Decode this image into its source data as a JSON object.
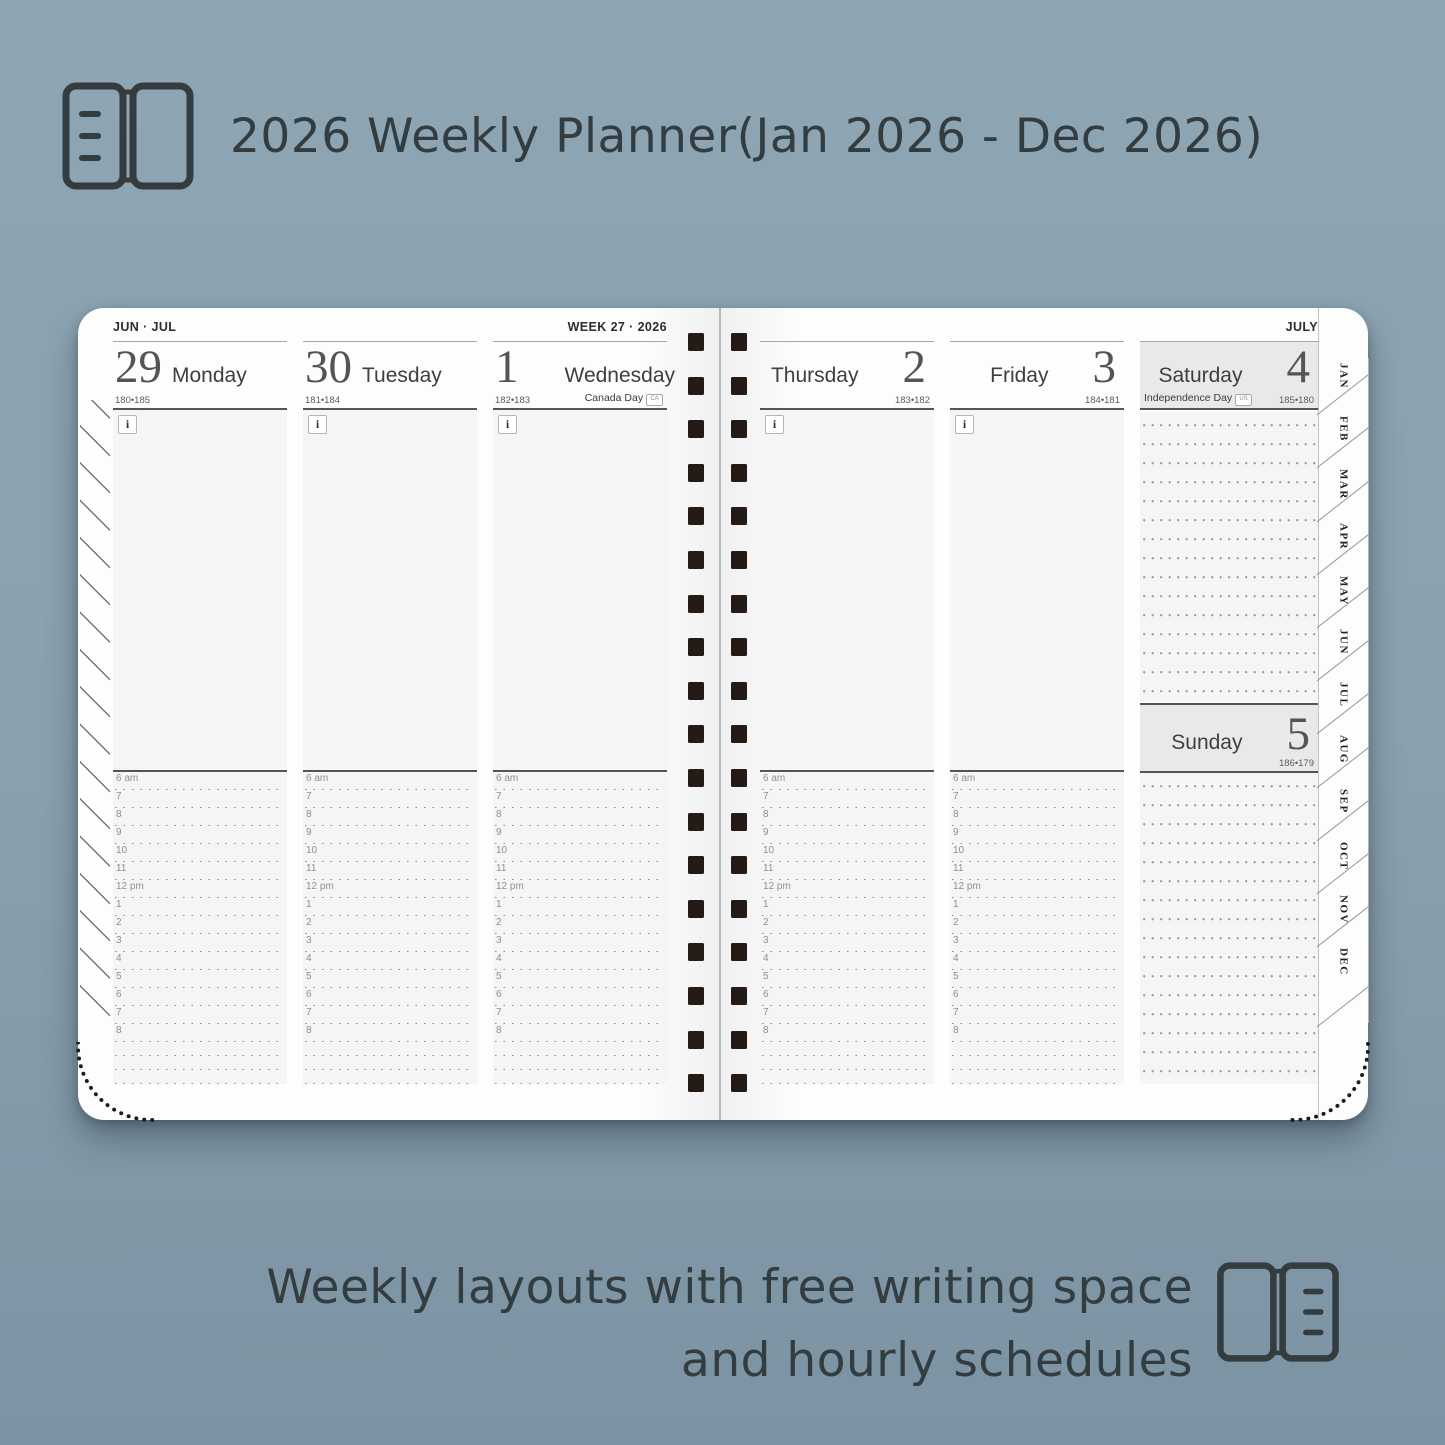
{
  "title": {
    "text": "2026 Weekly Planner(Jan 2026 - Dec 2026)"
  },
  "footer": {
    "line1": "Weekly layouts with free writing space",
    "line2": "and hourly schedules"
  },
  "planner": {
    "info_icon": "i",
    "left_page": {
      "month_label": "JUN · JUL",
      "week_label": "WEEK 27 · 2026",
      "days": [
        {
          "num": "29",
          "name": "Monday",
          "ordinal": "180•185"
        },
        {
          "num": "30",
          "name": "Tuesday",
          "ordinal": "181•184"
        },
        {
          "num": "1",
          "name": "Wednesday",
          "ordinal": "182•183",
          "holiday": "Canada Day",
          "holiday_badge": "CA"
        }
      ]
    },
    "right_page": {
      "month_label": "JULY",
      "days": [
        {
          "num": "2",
          "name": "Thursday",
          "ordinal": "183•182"
        },
        {
          "num": "3",
          "name": "Friday",
          "ordinal": "184•181"
        }
      ],
      "weekend": {
        "saturday": {
          "num": "4",
          "name": "Saturday",
          "ordinal": "185•180",
          "holiday": "Independence Day",
          "holiday_badge": "US"
        },
        "sunday": {
          "num": "5",
          "name": "Sunday",
          "ordinal": "186•179"
        }
      }
    },
    "hours": [
      "6 am",
      "7",
      "8",
      "9",
      "10",
      "11",
      "12 pm",
      "1",
      "2",
      "3",
      "4",
      "5",
      "6",
      "7",
      "8"
    ],
    "month_tabs": [
      "JAN",
      "FEB",
      "MAR",
      "APR",
      "MAY",
      "JUN",
      "JUL",
      "AUG",
      "SEP",
      "OCT",
      "NOV",
      "DEC"
    ]
  },
  "colors": {
    "background": "#8aa2b0",
    "heading_text": "#333c3e",
    "page": "#fdfdfd",
    "column_fill": "#f5f5f5",
    "weekend_header": "#e9e9e9",
    "spiral_hole": "#241b16"
  }
}
